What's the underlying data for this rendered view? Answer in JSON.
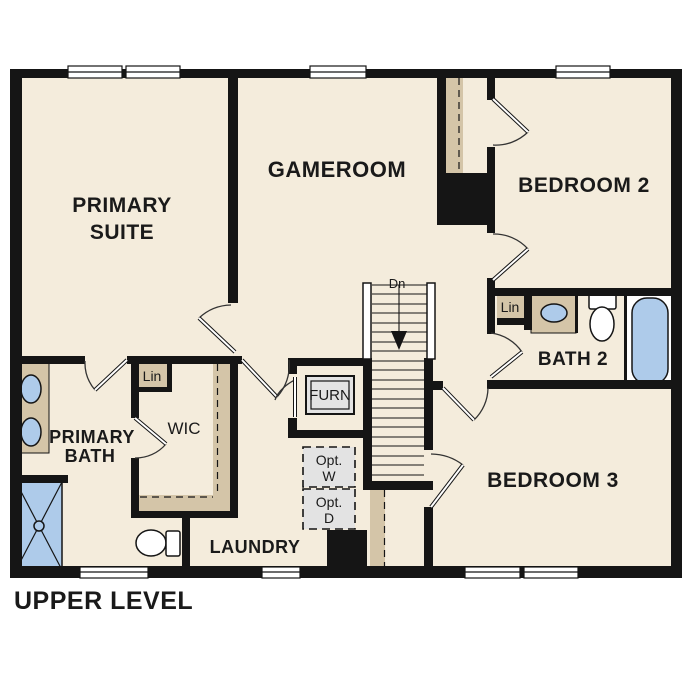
{
  "title": "UPPER LEVEL",
  "colors": {
    "background": "#ffffff",
    "floor": "#f4ecdc",
    "wall": "#151515",
    "casework_tan": "#d4c5a8",
    "fixture_blue": "#aecbea",
    "appliance_gray": "#e3e3e3"
  },
  "rooms": {
    "primary_suite": {
      "line1": "PRIMARY",
      "line2": "SUITE"
    },
    "gameroom": {
      "label": "GAMEROOM"
    },
    "bedroom2": {
      "label": "BEDROOM 2"
    },
    "bath2": {
      "label": "BATH 2"
    },
    "bedroom3": {
      "label": "BEDROOM 3"
    },
    "primary_bath": {
      "line1": "PRIMARY",
      "line2": "BATH"
    },
    "wic": {
      "label": "WIC"
    },
    "laundry": {
      "label": "LAUNDRY"
    }
  },
  "fixtures": {
    "linen_primary": "Lin",
    "linen_bath2": "Lin",
    "furnace": "FURN",
    "optional_washer": {
      "line1": "Opt.",
      "line2": "W"
    },
    "optional_dryer": {
      "line1": "Opt.",
      "line2": "D"
    },
    "stairs_direction": "Dn"
  }
}
